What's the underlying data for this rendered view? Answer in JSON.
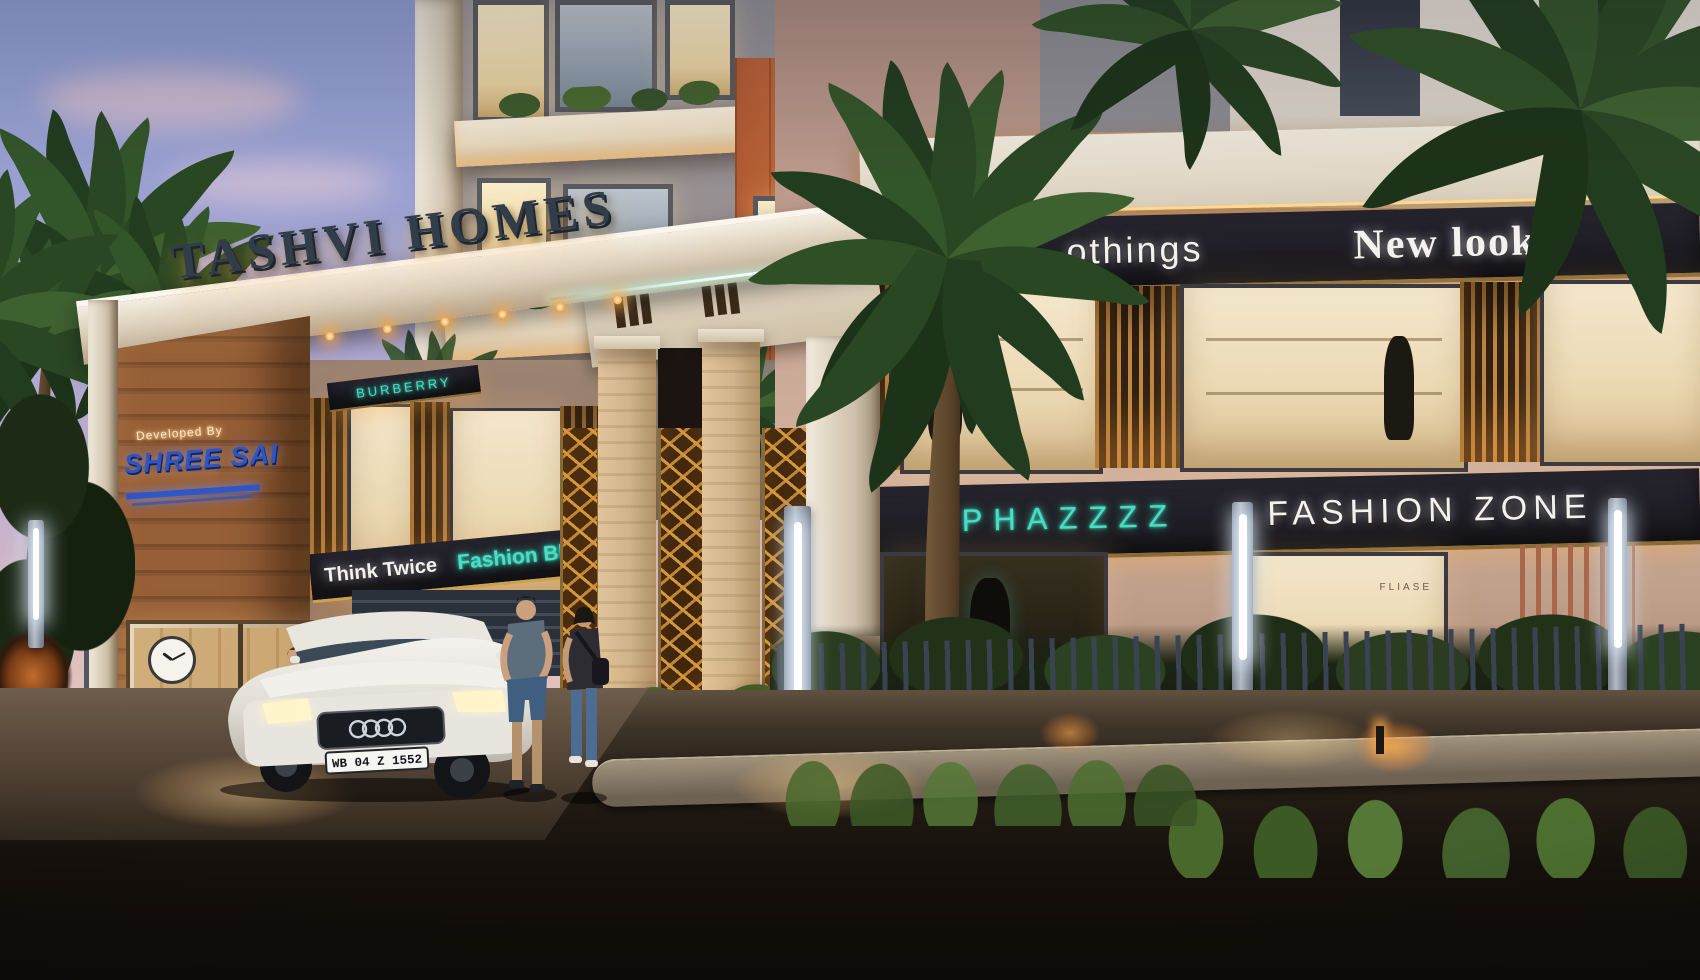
{
  "gate": {
    "title": "TASHVI HOMES",
    "developer_label": "Developed By",
    "developer_name": "SHREE SAI"
  },
  "shops": {
    "burberry": "BURBERRY",
    "think_twice": "Think Twice",
    "fashion_bling": "Fashion Bling",
    "clothings": "othings",
    "new_look": "New look",
    "phazzzz": "PHAZZZZ",
    "fashion_zone": "FASHION ZONE",
    "fliase": "FLIASE"
  },
  "vehicle": {
    "license_plate": "WB 04 Z 1552"
  },
  "security_cabin": {
    "clock_time": "10:10"
  },
  "colors": {
    "accent_teal": "#45e0c6",
    "sign_blue": "#2e55c4",
    "band_dark": "#1d1c22",
    "gold": "#c9973f",
    "letters_dark": "#323d4a",
    "sky_top": "#8c9bcf",
    "dusk_pink": "#f0ccb0",
    "wood_plank": "#8a5a33"
  }
}
